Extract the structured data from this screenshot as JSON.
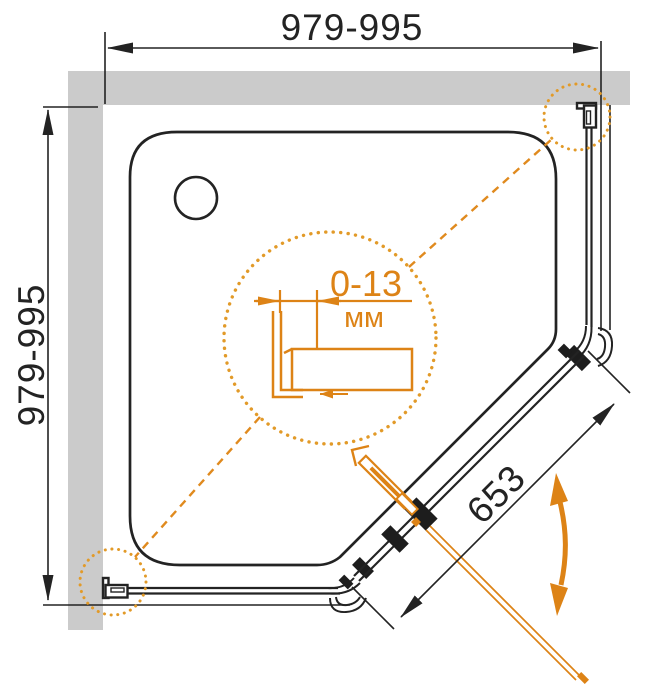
{
  "drawing": {
    "type": "shower-enclosure-installation-diagram",
    "dimensions": {
      "top_width": "979-995",
      "left_depth": "979-995",
      "door_width": "653",
      "adjustment_range": "0-13",
      "adjustment_unit": "мм"
    },
    "colors": {
      "accent_orange": "#dd8316",
      "wall_gray": "#cbcbcb",
      "line_dark": "#232323",
      "background": "#ffffff"
    }
  }
}
